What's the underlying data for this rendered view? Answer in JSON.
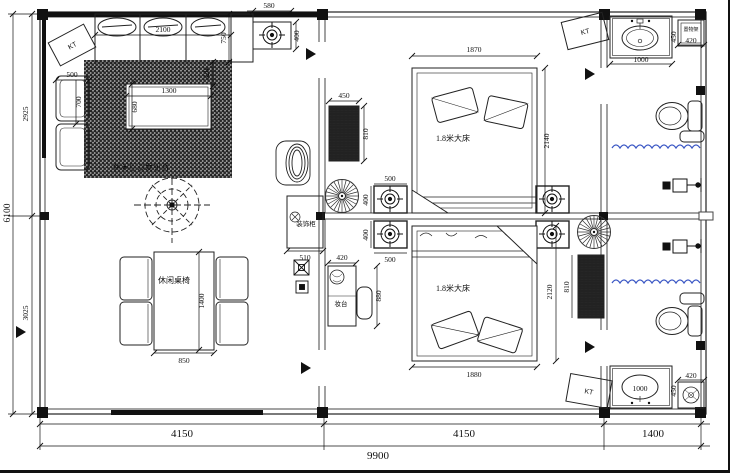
{
  "drawing": {
    "rooms": {
      "living_label": "休闲厅沙发组合",
      "dining_label": "休闲桌椅",
      "bed_label": "1.8米大床",
      "dresser_label": "妆台",
      "cabinet_label": "装饰柜",
      "shelf_label": "置物架",
      "ac_label": "KT"
    },
    "dimensions": {
      "overall_width": "9900",
      "overall_height": "6100",
      "bottom_segments": [
        "4150",
        "4150",
        "1400"
      ],
      "left_segments": [
        "2925",
        "3025"
      ],
      "sofa": {
        "width": "2100",
        "depth": "750",
        "gap": "320"
      },
      "top_vent": {
        "width": "580",
        "height": "400"
      },
      "armchair": {
        "width": "500",
        "depth": "700"
      },
      "coffee_table": {
        "width": "1300",
        "depth": "680"
      },
      "dining_table": {
        "width": "850",
        "length": "1400"
      },
      "cabinet_width": "510",
      "radiator_left": {
        "width": "450",
        "height": "810"
      },
      "radiator_right_height": "810",
      "bed_top": {
        "width": "1870",
        "length": "2140"
      },
      "bed_bottom": {
        "width": "1880",
        "length": "2120"
      },
      "wall_vent": {
        "width": "500",
        "height": "400"
      },
      "dresser": {
        "width": "420",
        "height": "880"
      },
      "vanity_top": {
        "width": "1000",
        "depth": "450"
      },
      "vanity_bottom": {
        "width": "1000",
        "depth": "450"
      },
      "shelf_top_width": "420",
      "shelf_bottom_width": "420"
    },
    "colors": {
      "line": "#222222",
      "curtain": "#3b57c4",
      "hatch": "#9a9a9a"
    }
  }
}
